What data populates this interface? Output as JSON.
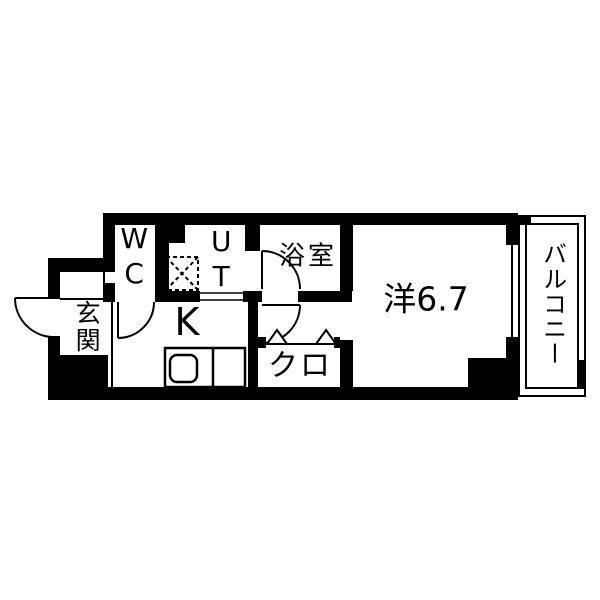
{
  "floor_plan": {
    "kind": "apartment-floor-plan",
    "rooms": {
      "entrance": {
        "label": "玄関"
      },
      "wc": {
        "label": "WC"
      },
      "utility": {
        "label": "UT"
      },
      "bathroom": {
        "label": "浴室"
      },
      "kitchen": {
        "label": "K"
      },
      "closet": {
        "label": "クロ"
      },
      "western_room": {
        "label": "洋6.7",
        "size_tatami": "6.7"
      },
      "balcony": {
        "label": "バルコニー"
      }
    },
    "colors": {
      "wall": "#000000",
      "floor": "#ffffff",
      "line": "#000000"
    }
  }
}
